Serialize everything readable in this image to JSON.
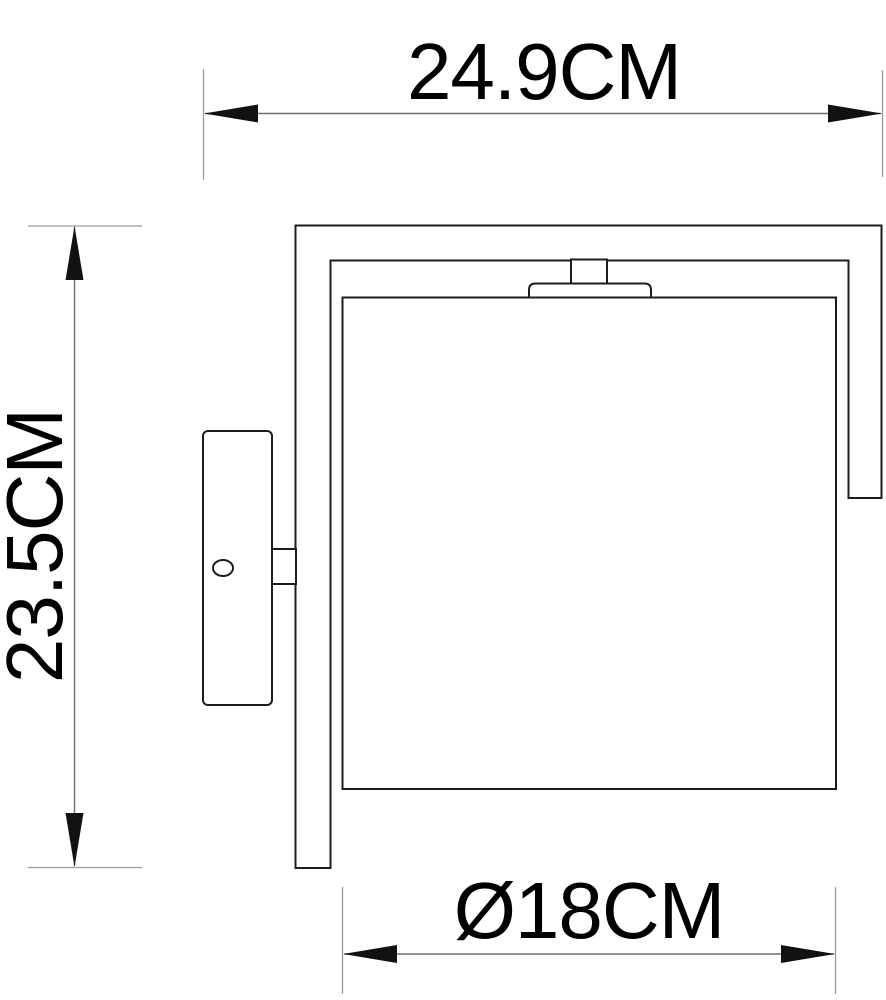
{
  "drawing": {
    "kind": "wall-lamp dimensional line drawing",
    "colors": {
      "background": "#ffffff",
      "fixture_outline": "#1c1c1c",
      "dimension_line": "#6f6f6f",
      "extension_line": "#9b9b9b",
      "arrowhead": "#121212",
      "label_text": "#000000"
    },
    "dimension_labels": {
      "overall_width": "24.9CM",
      "overall_height": "23.5CM",
      "shade_diameter": "Ø18CM"
    }
  }
}
